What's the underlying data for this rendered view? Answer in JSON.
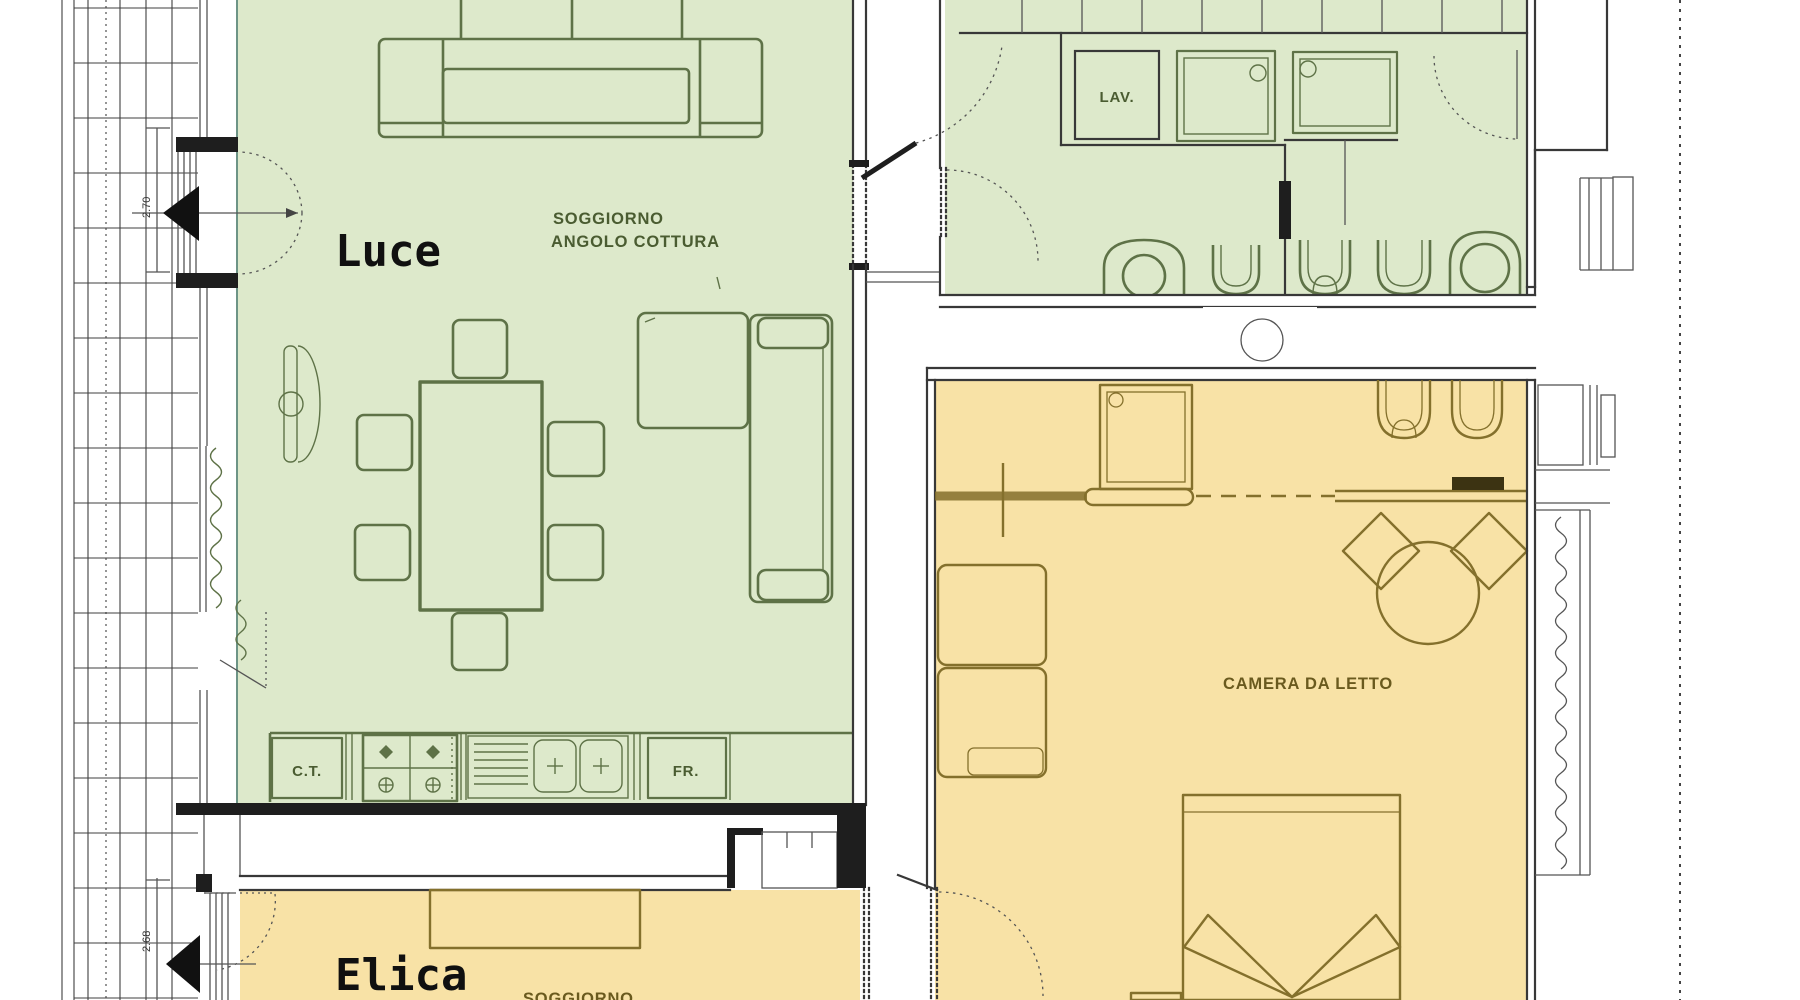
{
  "apartments": {
    "luce": {
      "name": "Luce",
      "living_room_label_line1": "SOGGIORNO",
      "living_room_label_line2": "ANGOLO COTTURA",
      "bedroom_label": "CAMERA DA LETTO",
      "kitchen_unit_left": "C.T.",
      "kitchen_unit_right": "FR.",
      "laundry_label": "LAV."
    },
    "elica": {
      "name": "Elica",
      "living_room_label": "SOGGIORNO"
    }
  },
  "dimensions": {
    "balcony_door_top": "2.70",
    "balcony_door_bottom": "2.68"
  },
  "colors": {
    "wall": "#383838",
    "room-green": "#dde9cb",
    "room-yellow": "#f8e2a6",
    "furn-green": "#5e7247",
    "furn-yellow": "#84702c",
    "text-green": "#4a5c31",
    "text-yellow": "#6a5a1e",
    "text-dark": "#101010"
  }
}
